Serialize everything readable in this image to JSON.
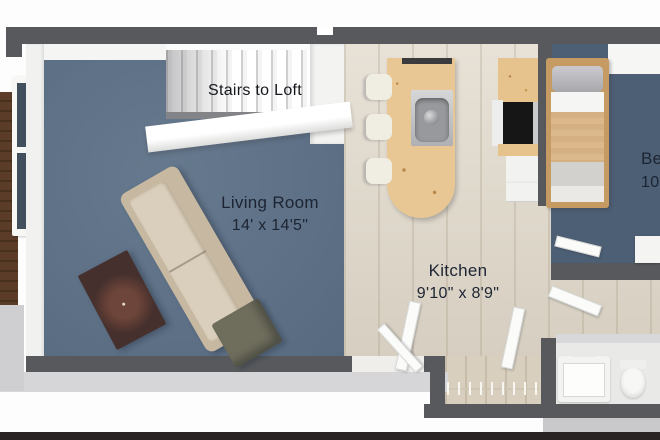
{
  "scene_type": "3d-floorplan-render",
  "labels": {
    "stairs": "Stairs to Loft",
    "living_room_name": "Living Room",
    "living_room_dims": "14' x 14'5\"",
    "kitchen_name": "Kitchen",
    "kitchen_dims": "9'10\" x 8'9\"",
    "bedroom_name_clipped": "Be",
    "bedroom_dims_clipped": "10"
  },
  "colors": {
    "wall": "#57595c",
    "living_carpet": "#5e7288",
    "bedroom_carpet": "#4d5f75",
    "kitchen_floor": "#ded6c7",
    "island_wood": "#e9c795",
    "counter_wood": "#e6c28c",
    "deck_wood": "#5a3c29",
    "sofa_body": "#c6b8a1",
    "sofa_cushion": "#dacfbc",
    "coffee_table": "#46302d",
    "ottoman": "#6f6d5c",
    "bed_frame": "#c59b63",
    "bed_blanket": "#dcb98c",
    "label_text": "#1d2433"
  }
}
